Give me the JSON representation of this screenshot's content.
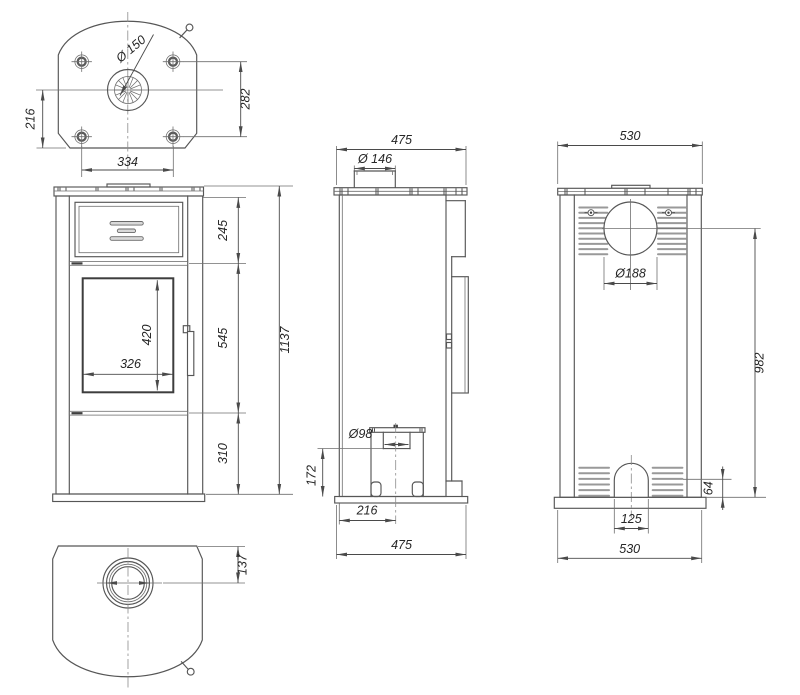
{
  "title": "Free-standing stove dimensional drawing",
  "colors": {
    "background": "#ffffff",
    "outline": "#565656",
    "dimension_line": "#4a4a4a",
    "text": "#262626"
  },
  "views": {
    "top": {
      "dims": {
        "flue_diameter": "Ø 150",
        "depth_left": "216",
        "bolt_vertical": "282",
        "bolt_horizontal": "334"
      }
    },
    "front": {
      "dims": {
        "upper_section": "245",
        "middle_section": "545",
        "lower_section": "310",
        "total_height": "1137",
        "glass_height": "420",
        "glass_width": "326"
      }
    },
    "side": {
      "dims": {
        "width_top": "475",
        "flue_collar_diameter": "Ø 146",
        "air_inlet_diameter": "Ø98",
        "inlet_height": "172",
        "inlet_offset": "216",
        "width_bottom": "475"
      }
    },
    "back": {
      "dims": {
        "width_top": "530",
        "flue_hole_diameter": "Ø188",
        "flue_center_height": "982",
        "plinth_height": "64",
        "arch_width": "125",
        "width_bottom": "530"
      }
    },
    "bottom": {
      "dims": {
        "flue_center_offset": "137"
      }
    }
  }
}
